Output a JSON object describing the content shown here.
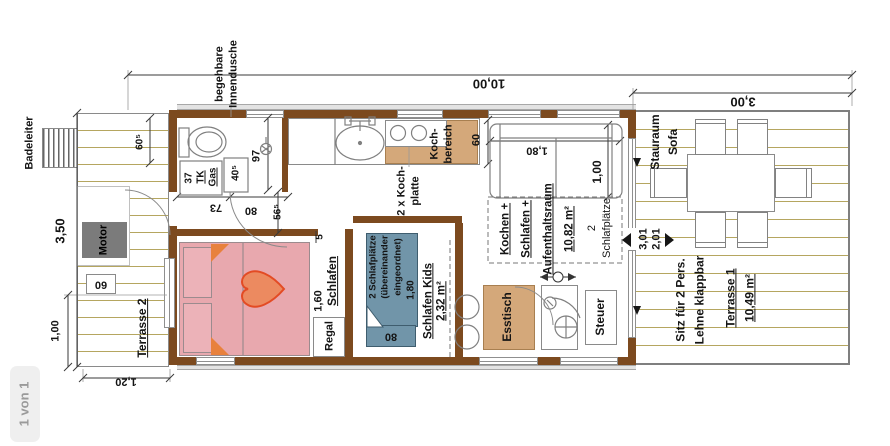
{
  "viewer": {
    "page_indicator": "1 von 1"
  },
  "plan": {
    "dims": {
      "total_length": "10,00",
      "terrace_length": "3,00",
      "hull_width": "3,50",
      "platform_height": "1,00",
      "platform_width": "1,20",
      "toilet_width": "60⁵",
      "shower_length": "97",
      "tk_width": "37",
      "closet_width": "40⁵",
      "hall_a": "73",
      "hall_b": "80",
      "hall_depth": "56⁵",
      "wall_gap": "5",
      "counter_depth": "60",
      "sofa_length": "1,80",
      "sofa_depth": "1,00",
      "bed_width": "1,60",
      "bunk_length": "1,80",
      "bunk_width": "80",
      "motor_step": "60",
      "door_outer": "3,01",
      "door_inner": "2,01"
    },
    "rooms": {
      "badeleiter": "Badeleiter",
      "innendusche": [
        "begehbare",
        "Innendusche"
      ],
      "motor": "Motor",
      "terrasse2": "Terrasse 2",
      "tkgas": [
        "TK",
        "Gas"
      ],
      "kochplatte": [
        "2 x Koch-",
        "platte"
      ],
      "kochbereich": [
        "Koch-",
        "bereich"
      ],
      "aufenthaltsraum": [
        "Kochen +",
        "Schlafen +",
        "Aufenthaltsraum",
        "10,82 m²"
      ],
      "schlafplaetze": [
        "2",
        "Schlafplätze"
      ],
      "bunk": [
        "2 Schlafplätze",
        "(übereinander",
        "eingeordnet)"
      ],
      "bunk_dim": "1,80",
      "schlafen": "Schlafen",
      "regal": "Regal",
      "kids": [
        "Schlafen Kids",
        "2,32 m²"
      ],
      "esstisch": "Esstisch",
      "steuer": "Steuer",
      "stauraum": [
        "Stauraum",
        "Sofa"
      ],
      "sitz": [
        "Sitz für 2 Pers.",
        "Lehne klappbar"
      ],
      "terrasse1": [
        "Terrasse 1",
        "10,49 m²"
      ]
    },
    "colors": {
      "wall": "#7c4a1f",
      "plank_line": "#b5a660",
      "bed": "#e8a8ae",
      "bunk": "#7195a9",
      "wood": "#d4a87a",
      "motor": "#7b7b7b",
      "heart": "#ec8a60",
      "heart_outline": "#e34b24",
      "fold_triangle": "#e8813d"
    }
  }
}
